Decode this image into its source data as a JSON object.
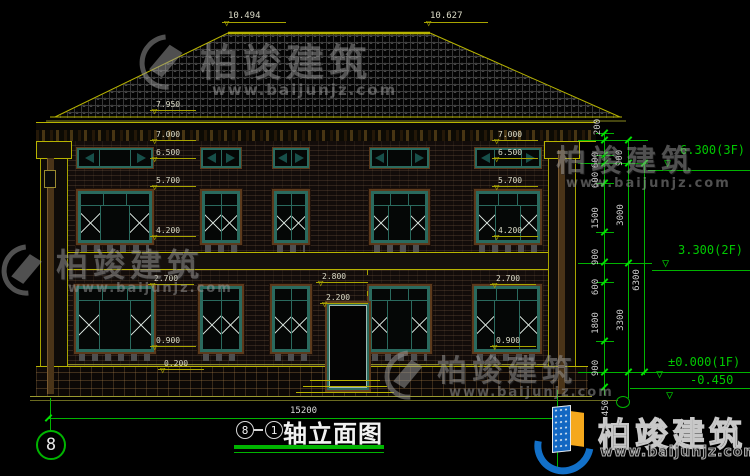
{
  "title_block": {
    "axis_start": "8",
    "axis_end": "1",
    "title": "轴立面图"
  },
  "axis_bubble": "8",
  "brand": {
    "name": "柏竣建筑",
    "url": "www.baijunjz.com"
  },
  "dims": {
    "top": [
      "10.494",
      "10.627"
    ],
    "left_col": [
      "7.950",
      "7.000",
      "6.500",
      "5.700",
      "4.200",
      "2.700",
      "0.900",
      "0.200"
    ],
    "right_col": [
      "7.000",
      "6.500",
      "5.700",
      "4.200",
      "2.700",
      "0.900"
    ],
    "door": [
      "2.800",
      "2.200"
    ],
    "width_total": "15200",
    "chain_fine": [
      "200",
      "900",
      "600",
      "600",
      "1500",
      "900",
      "600",
      "1800",
      "900",
      "450"
    ],
    "chain_floor": [
      "3000",
      "3300"
    ],
    "chain_total": "6300",
    "levels": [
      "6.300(3F)",
      "3.300(2F)",
      "±0.000(1F)",
      "-0.450"
    ]
  },
  "colors": {
    "dim_green": "#00b400",
    "cad_yellow": "#b8b400",
    "frame_teal": "#2a6a5e",
    "trim_brown": "#5c3a1c",
    "brand_blue": "#1270c8",
    "brand_orange": "#f5a81c"
  }
}
